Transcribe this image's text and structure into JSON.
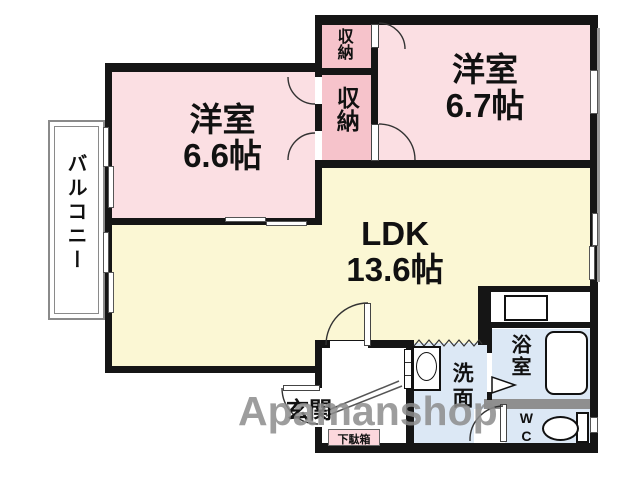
{
  "rooms": {
    "bedroom_left": {
      "name": "洋室",
      "size": "6.6帖"
    },
    "bedroom_right": {
      "name": "洋室",
      "size": "6.7帖"
    },
    "ldk": {
      "name": "LDK",
      "size": "13.6帖"
    },
    "closet_upper": "収納",
    "closet_lower": "収納",
    "balcony": "バルコニー",
    "bathroom": "浴室",
    "washroom": "洗面",
    "wc": "WC",
    "entrance": "玄関",
    "shoe_cabinet": "下駄箱"
  },
  "watermark": "Apamanshop",
  "colors": {
    "room_pink": "#fbdfe3",
    "closet_pink": "#f6c3cb",
    "ldk_yellow": "#fbf7d4",
    "water_blue": "#dce8f5",
    "shoebox_pink": "#fcd7dc",
    "wall_black": "#151515",
    "partition_gray": "#8f8f8f",
    "watermark_gray": "#8d8d8d"
  }
}
